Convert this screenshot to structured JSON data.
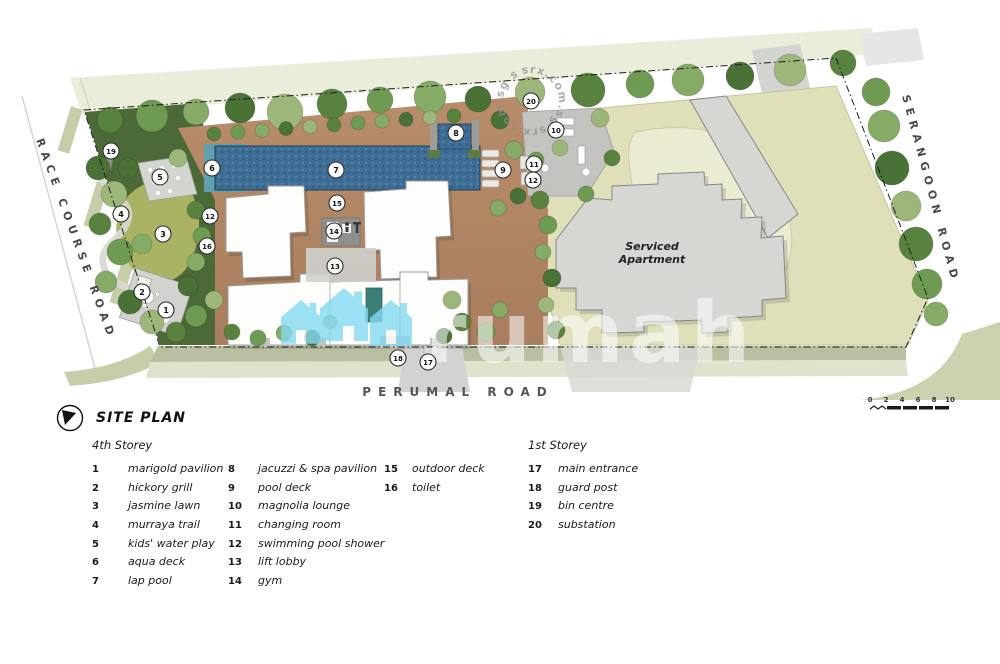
{
  "plan": {
    "roads": {
      "left": "RACE COURSE ROAD",
      "right": "SERANGOON ROAD",
      "bottom": "PERUMAL ROAD"
    },
    "building_label": "Serviced Apartment",
    "building_label_lines": [
      "Serviced",
      "Apartment"
    ],
    "watermark": {
      "logo_text": "rumah",
      "circle_text": "srx.com.sg",
      "circle_text_display": "srx.com.sg  srx.com.sg  srx.com.sg"
    },
    "markers": [
      {
        "n": 19,
        "x": 111,
        "y": 151
      },
      {
        "n": 5,
        "x": 160,
        "y": 177
      },
      {
        "n": 6,
        "x": 212,
        "y": 168
      },
      {
        "n": 7,
        "x": 336,
        "y": 170
      },
      {
        "n": 8,
        "x": 456,
        "y": 133
      },
      {
        "n": 20,
        "x": 531,
        "y": 101
      },
      {
        "n": 10,
        "x": 556,
        "y": 130
      },
      {
        "n": 11,
        "x": 534,
        "y": 164
      },
      {
        "n": 12,
        "x": 533,
        "y": 180
      },
      {
        "n": 9,
        "x": 503,
        "y": 170
      },
      {
        "n": 15,
        "x": 337,
        "y": 203
      },
      {
        "n": 14,
        "x": 334,
        "y": 231
      },
      {
        "n": 12,
        "x": 210,
        "y": 216
      },
      {
        "n": 16,
        "x": 207,
        "y": 246
      },
      {
        "n": 13,
        "x": 335,
        "y": 266
      },
      {
        "n": 4,
        "x": 121,
        "y": 214
      },
      {
        "n": 3,
        "x": 163,
        "y": 234
      },
      {
        "n": 2,
        "x": 142,
        "y": 292
      },
      {
        "n": 1,
        "x": 166,
        "y": 310
      },
      {
        "n": 18,
        "x": 398,
        "y": 358
      },
      {
        "n": 17,
        "x": 428,
        "y": 362
      }
    ]
  },
  "legend": {
    "title": "SITE PLAN",
    "columns": [
      {
        "header": "4th Storey",
        "items": [
          {
            "n": "1",
            "label": "marigold pavilion"
          },
          {
            "n": "2",
            "label": "hickory grill"
          },
          {
            "n": "3",
            "label": "jasmine lawn"
          },
          {
            "n": "4",
            "label": "murraya trail"
          },
          {
            "n": "5",
            "label": "kids' water play"
          },
          {
            "n": "6",
            "label": "aqua deck"
          },
          {
            "n": "7",
            "label": "lap pool"
          }
        ]
      },
      {
        "header": "",
        "items": [
          {
            "n": "8",
            "label": "jacuzzi & spa pavilion"
          },
          {
            "n": "9",
            "label": "pool deck"
          },
          {
            "n": "10",
            "label": "magnolia lounge"
          },
          {
            "n": "11",
            "label": "changing room"
          },
          {
            "n": "12",
            "label": "swimming pool shower"
          },
          {
            "n": "13",
            "label": "lift lobby"
          },
          {
            "n": "14",
            "label": "gym"
          }
        ]
      },
      {
        "header": "",
        "items": [
          {
            "n": "15",
            "label": "outdoor deck"
          },
          {
            "n": "16",
            "label": "toilet"
          }
        ]
      },
      {
        "header": "1st Storey",
        "items": [
          {
            "n": "17",
            "label": "main entrance"
          },
          {
            "n": "18",
            "label": "guard post"
          },
          {
            "n": "19",
            "label": "bin centre"
          },
          {
            "n": "20",
            "label": "substation"
          }
        ]
      }
    ],
    "scale": {
      "ticks": [
        "0",
        "2",
        "4",
        "6",
        "8",
        "10"
      ]
    }
  },
  "colors": {
    "pool": "#3e6e95",
    "deck": "#b48a68",
    "lawn": "#aab363",
    "khaki_plot": "#dfe0ba",
    "tree_dark": "#4a7136",
    "watermark_blue": "#85d9f2",
    "building_gray": "#d6d6d3"
  }
}
